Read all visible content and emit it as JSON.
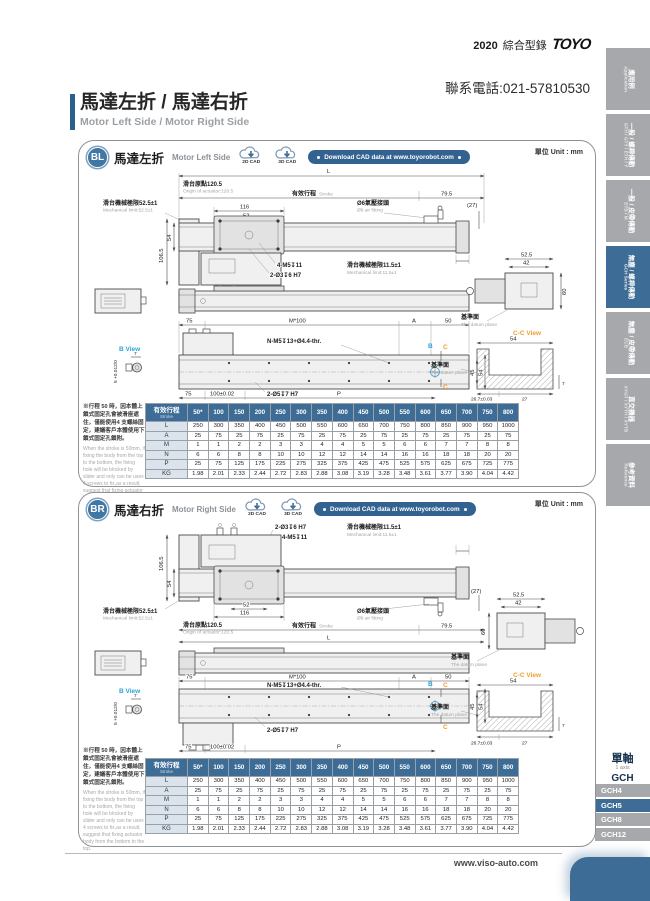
{
  "page_header": {
    "year": "2020",
    "catalog": "綜合型錄",
    "brand": "TOYO",
    "phone": "聯系電話:021-57810530"
  },
  "title": {
    "zh": "馬達左折 / 馬達右折",
    "en": "Motor Left Side / Motor Right Side"
  },
  "unit_label": "單位 Unit : mm",
  "cad": {
    "cad2d": "2D CAD",
    "cad3d": "3D CAD",
    "download": "Download CAD data at www.toyorobot.com"
  },
  "sections": {
    "bl": {
      "code": "BL",
      "title_zh": "馬達左折",
      "title_en": "Motor Left Side"
    },
    "br": {
      "code": "BR",
      "title_zh": "馬達右折",
      "title_en": "Motor Right Side"
    }
  },
  "drawing": {
    "L": "L",
    "origin_zh": "滑台原點120.5",
    "origin_en": "Origin of actuator:120.5",
    "stroke_zh": "有效行程",
    "stroke_en": "Stroke",
    "d79": "79.5",
    "d27": "(27)",
    "mech52_zh": "滑台機械極限52.5±1",
    "mech52_en": "Mechanical limit:52.5±1",
    "mech11_zh": "滑台機械極限11.5±1",
    "mech11_en": "Mechanical limit:11.5±1",
    "d116": "116",
    "d52": "52",
    "air_zh": "Ø6氣壓接頭",
    "air_en": "Ø6 air fitting",
    "d106": "106.5",
    "d54": "54",
    "tap": "4-M5↧11",
    "pin3": "2-Ø3↧6 H7",
    "d75": "75",
    "m100": "M*100",
    "A": "A",
    "d50": "50",
    "nm5": "N-M5↧13+Ø4.4-thr.",
    "B": "B",
    "C": "C",
    "d45": "45",
    "pin5": "2-Ø5↧7 H7",
    "d100": "100±0.02",
    "P": "P",
    "bview": "B View",
    "d7": "7",
    "tol5": "5 +0.012/0",
    "d525": "52.5",
    "d42": "42",
    "d60": "60",
    "datum_zh": "基準面",
    "datum_en": "The datum plane",
    "ccview": "C-C View",
    "d267": "26.7±0.03",
    "d27b": "27"
  },
  "note": {
    "zh": "※行程 50 時，因本體上鎖式固定孔會被滑座遮住，僅能使用4 支螺絲固定，建議客戶本體使用下鎖式固定孔鎖附。",
    "en": "When the stroke is 50mm, if fixing the body from the top to the bottom, the fixing hole will be blocked by slider and only can be uses 4 screws to fix,as a result, suggest that fixing actuator body from the bottom to the top."
  },
  "table": {
    "head_zh": "有效行程",
    "head_en": "Stroke",
    "strokes": [
      "50*",
      "100",
      "150",
      "200",
      "250",
      "300",
      "350",
      "400",
      "450",
      "500",
      "550",
      "600",
      "650",
      "700",
      "750",
      "800"
    ],
    "rows": [
      {
        "label": "L",
        "values": [
          "250",
          "300",
          "350",
          "400",
          "450",
          "500",
          "550",
          "600",
          "650",
          "700",
          "750",
          "800",
          "850",
          "900",
          "950",
          "1000"
        ]
      },
      {
        "label": "A",
        "values": [
          "25",
          "75",
          "25",
          "75",
          "25",
          "75",
          "25",
          "75",
          "25",
          "75",
          "25",
          "75",
          "25",
          "75",
          "25",
          "75"
        ]
      },
      {
        "label": "M",
        "values": [
          "1",
          "1",
          "2",
          "2",
          "3",
          "3",
          "4",
          "4",
          "5",
          "5",
          "6",
          "6",
          "7",
          "7",
          "8",
          "8"
        ]
      },
      {
        "label": "N",
        "values": [
          "6",
          "6",
          "8",
          "8",
          "10",
          "10",
          "12",
          "12",
          "14",
          "14",
          "16",
          "16",
          "18",
          "18",
          "20",
          "20"
        ]
      },
      {
        "label": "P",
        "values": [
          "25",
          "75",
          "125",
          "175",
          "225",
          "275",
          "325",
          "375",
          "425",
          "475",
          "525",
          "575",
          "625",
          "675",
          "725",
          "775"
        ]
      },
      {
        "label": "KG",
        "values": [
          "1.98",
          "2.01",
          "2.33",
          "2.44",
          "2.72",
          "2.83",
          "2.88",
          "3.08",
          "3.19",
          "3.28",
          "3.48",
          "3.61",
          "3.77",
          "3.90",
          "4.04",
          "4.42"
        ]
      }
    ]
  },
  "sidebar": {
    "tabs": [
      {
        "zh": "應用例",
        "en": "Application",
        "active": false
      },
      {
        "zh": "一般 / 螺桿傳動",
        "en": "GTH / GTY / ETH / Y",
        "active": false
      },
      {
        "zh": "一般 / 皮帶傳動",
        "en": "ETB / M",
        "active": false
      },
      {
        "zh": "無塵 / 螺桿傳動",
        "en": "GCH Series",
        "active": true
      },
      {
        "zh": "無塵 / 皮帶傳動",
        "en": "ECB",
        "active": false
      },
      {
        "zh": "直交機器",
        "en": "XYGT / XYTH / XYTB",
        "active": false
      },
      {
        "zh": "參考資料",
        "en": "Reference",
        "active": false
      }
    ],
    "series": {
      "zh": "單軸",
      "en": "1 axis",
      "name": "GCH"
    },
    "models": [
      {
        "label": "GCH4",
        "active": false
      },
      {
        "label": "GCH5",
        "active": true
      },
      {
        "label": "GCH8",
        "active": false
      },
      {
        "label": "GCH12",
        "active": false
      }
    ],
    "colors": {
      "active": "#3d6d96",
      "idle": "#a6a8ab"
    }
  },
  "footer": {
    "url": "www.viso-auto.com"
  }
}
